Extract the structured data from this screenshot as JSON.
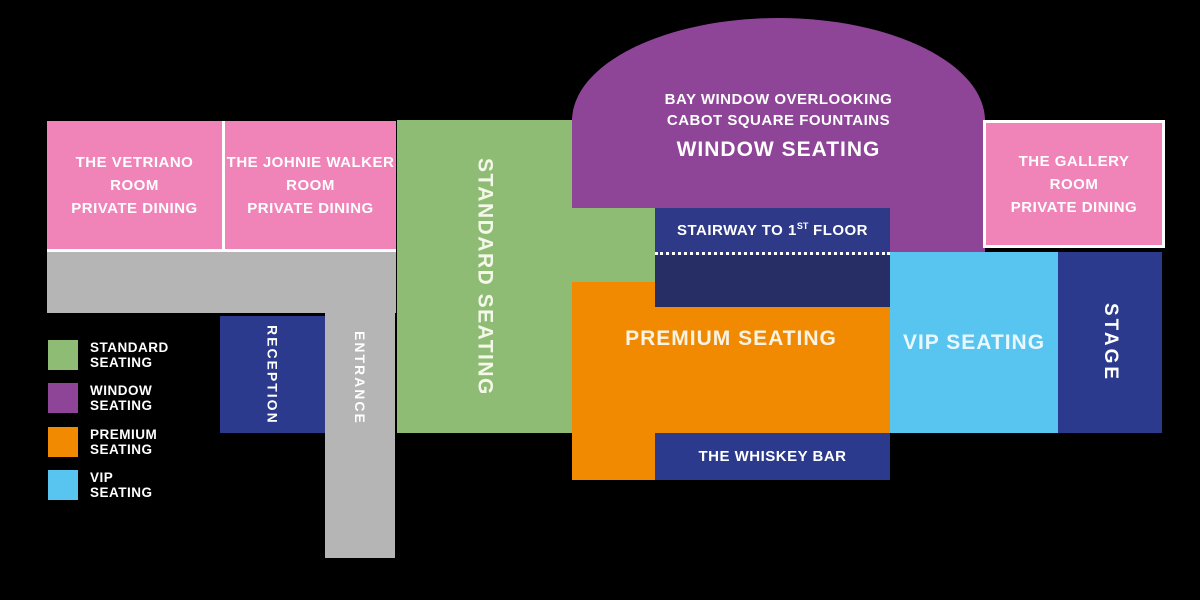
{
  "colors": {
    "background": "#000000",
    "standard_seating": "#8FBC75",
    "window_seating": "#8E4598",
    "premium_seating": "#F18A00",
    "vip_seating": "#58C5F1",
    "navy": "#2B3A8C",
    "navy_dark": "#272E66",
    "pink_private_dining": "#F083B8",
    "corridor_gray": "#B5B5B5",
    "text": "#FFFFFF"
  },
  "rooms": {
    "vetriano": {
      "line1": "THE VETRIANO",
      "line2": "ROOM",
      "line3": "PRIVATE DINING"
    },
    "johnie_walker": {
      "line1": "THE JOHNIE WALKER",
      "line2": "ROOM",
      "line3": "PRIVATE DINING"
    },
    "gallery": {
      "line1": "THE GALLERY",
      "line2": "ROOM",
      "line3": "PRIVATE DINING"
    }
  },
  "zones": {
    "standard": {
      "label": "STANDARD SEATING"
    },
    "window": {
      "line1": "BAY WINDOW OVERLOOKING",
      "line2": "CABOT SQUARE FOUNTAINS",
      "label": "WINDOW SEATING"
    },
    "premium": {
      "label": "PREMIUM SEATING"
    },
    "vip": {
      "label": "VIP SEATING"
    },
    "stage": {
      "label": "STAGE"
    },
    "stairway": {
      "prefix": "STAIRWAY TO 1",
      "sup": "ST",
      "suffix": " FLOOR"
    },
    "whiskey_bar": {
      "label": "THE WHISKEY BAR"
    },
    "reception": {
      "label": "RECEPTION"
    },
    "entrance": {
      "label": "ENTRANCE"
    }
  },
  "legend": {
    "items": [
      {
        "line1": "STANDARD",
        "line2": "SEATING",
        "color": "#8FBC75"
      },
      {
        "line1": "WINDOW",
        "line2": "SEATING",
        "color": "#8E4598"
      },
      {
        "line1": "PREMIUM",
        "line2": "SEATING",
        "color": "#F18A00"
      },
      {
        "line1": "VIP",
        "line2": "SEATING",
        "color": "#58C5F1"
      }
    ]
  }
}
